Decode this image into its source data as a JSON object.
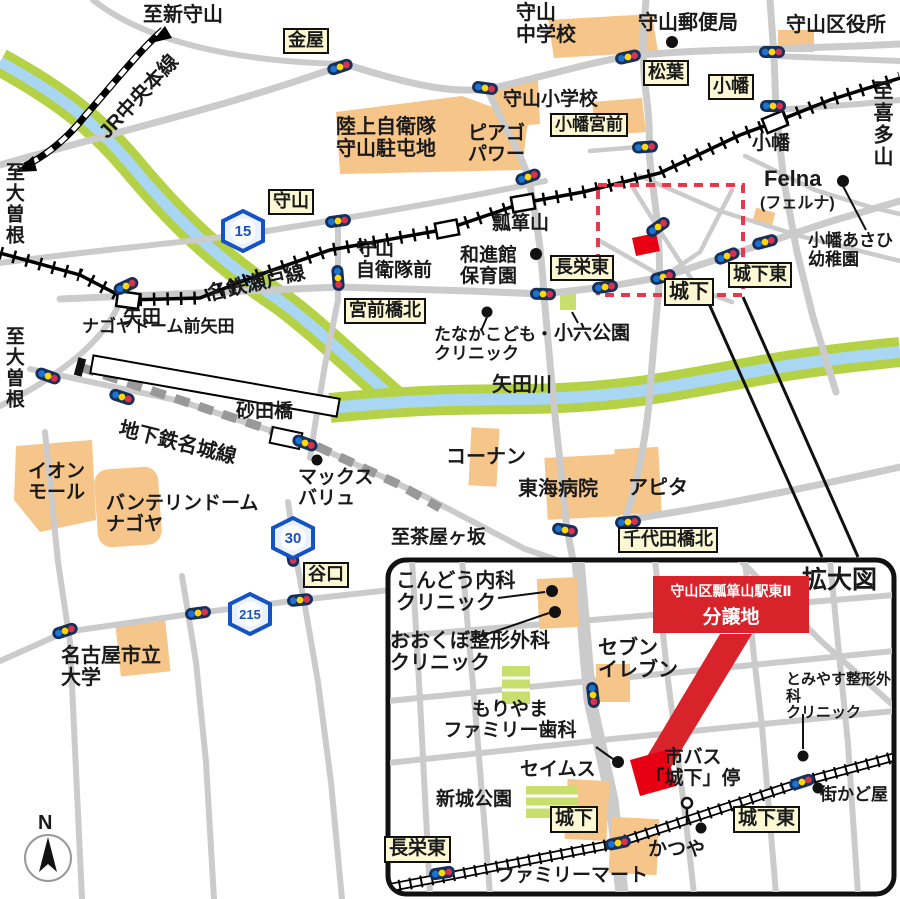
{
  "map": {
    "compass": "N",
    "dirs": {
      "shin_moriyama": "至新守山",
      "kitayama": "至喜多山",
      "ozone_1": "至大曽根",
      "ozone_2": "至大曽根",
      "chayagasaka": "至茶屋ヶ坂"
    },
    "rails": {
      "jr": "JR中央本線",
      "meitetsu": "名鉄瀬戸線",
      "subway": "地下鉄名城線"
    },
    "stations": {
      "obata": "小幡",
      "yada": "矢田",
      "hyotanyama": "瓢箪山",
      "jsdf": "守山\n自衛隊前",
      "nagoya_dome": "ナゴヤドーム前矢田",
      "sunadabashi": "砂田橋"
    },
    "badges": {
      "kanaya": "金屋",
      "matsuba": "松葉",
      "obata": "小幡",
      "obata_miyamae": "小幡宮前",
      "moriyama": "守山",
      "choei_higashi": "長栄東",
      "shiroshita": "城下",
      "shiroshita_higashi": "城下東",
      "miyamaebashi_kita": "宮前橋北",
      "chiyodabashi_kita": "千代田橋北",
      "taniguchi": "谷口"
    },
    "pois": {
      "moriyama_jhs": "守山\n中学校",
      "moriyama_post": "守山郵便局",
      "moriyama_ward": "守山区役所",
      "moriyama_es": "守山小学校",
      "jsdf_base": "陸上自衛隊\n守山駐屯地",
      "piago": "ピアゴ\nパワー",
      "felna": "Felna",
      "felna_kana": "(フェルナ)",
      "obata_asahi": "小幡あさひ\n幼稚園",
      "washinkan": "和進館\n保育園",
      "tanaka_clinic": "たなかこども・\nクリニック",
      "koroku_park": "小六公園",
      "yada_river": "矢田川",
      "max_valu": "マックス\nバリュ",
      "konan": "コーナン",
      "tokai_hospital": "東海病院",
      "apita": "アピタ",
      "aeon_mall": "イオン\nモール",
      "vantelin_dome": "バンテリンドーム\nナゴヤ",
      "nagoya_city_univ": "名古屋市立\n大学"
    },
    "shields": {
      "r15": "15",
      "r30": "30",
      "r215": "215"
    },
    "inset": {
      "title": "拡大図",
      "banner_line1": "守山区瓢箪山駅東Ⅱ",
      "banner_line2": "分譲地",
      "kondo_clinic": "こんどう内科\nクリニック",
      "okubo_clinic": "おおくぼ整形外科\nクリニック",
      "seven_eleven": "セブン\nイレブン",
      "tomiyasu_clinic": "とみやす整形外科\nクリニック",
      "moriyama_dental": "もりやま\nファミリー歯科",
      "seims": "セイムス",
      "shinshiro_park": "新城公園",
      "bus_stop": "市バス\n「城下」停",
      "katsuya": "かつや",
      "machikadoya": "街かど屋",
      "familymart": "ファミリーマート",
      "badges": {
        "shiroshita": "城下",
        "shiroshita_higashi": "城下東",
        "choei_higashi": "長栄東"
      }
    }
  }
}
